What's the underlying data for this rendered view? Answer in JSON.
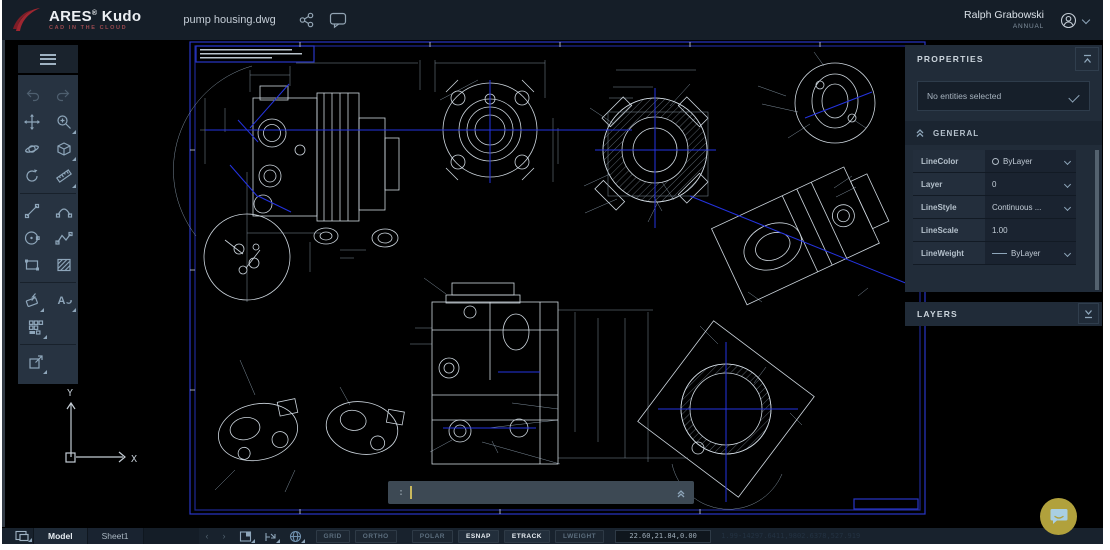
{
  "topbar": {
    "brand": "ARES",
    "brand_reg": "®",
    "brand_suffix": " Kudo",
    "brand_tagline": "CAD IN THE CLOUD",
    "filename": "pump housing.dwg",
    "user_name": "Ralph Grabowski",
    "user_plan": "ANNUAL"
  },
  "toolbar": {
    "tools": [
      "undo",
      "redo",
      "pan",
      "zoom",
      "orbit",
      "named-views",
      "rotate-view",
      "measure",
      "line",
      "arc",
      "circle",
      "polyline",
      "rectangle",
      "hatch",
      "modify",
      "text",
      "blocks",
      "export"
    ]
  },
  "properties_panel": {
    "title": "PROPERTIES",
    "selection_placeholder": "No entities selected",
    "general_section": "GENERAL",
    "rows": [
      {
        "label": "LineColor",
        "value": "ByLayer"
      },
      {
        "label": "Layer",
        "value": "0"
      },
      {
        "label": "LineStyle",
        "value": "Continuous ..."
      },
      {
        "label": "LineScale",
        "value": "1.00"
      },
      {
        "label": "LineWeight",
        "value": "ByLayer"
      }
    ]
  },
  "layers_panel": {
    "title": "LAYERS"
  },
  "command_bar": {
    "prompt": ":"
  },
  "statusbar": {
    "tabs": [
      "Model",
      "Sheet1"
    ],
    "nav_prev": "‹",
    "nav_next": "›",
    "toggles": [
      {
        "label": "GRID",
        "active": false
      },
      {
        "label": "ORTHO",
        "active": false
      },
      {
        "label": "POLAR",
        "active": false
      },
      {
        "label": "ESNAP",
        "active": true
      },
      {
        "label": "ETRACK",
        "active": true
      },
      {
        "label": "LWEIGHT",
        "active": false
      }
    ],
    "coordinates": "22.60,21.84,0.00",
    "session_info": "1.99-14297.6411,9802.6378,527.919"
  },
  "ucs": {
    "x_label": "X",
    "y_label": "Y"
  },
  "colors": {
    "accent_blue": "#2433e0",
    "line_white": "#cdd6de",
    "dim_text": "#9aabba",
    "chat_fab": "#b1a13c"
  },
  "canvas": {
    "sheet_code": "E**120-E905 B",
    "texts": [
      {
        "x": 204,
        "y": 84,
        "s": "64.47°"
      },
      {
        "x": 248,
        "y": 73,
        "s": "1.44"
      },
      {
        "x": 256,
        "y": 86,
        "s": ".78"
      },
      {
        "x": 326,
        "y": 61,
        "s": "3.10"
      },
      {
        "x": 408,
        "y": 75,
        "s": "1.85"
      },
      {
        "x": 452,
        "y": 79,
        "s": "Ø.31 THRU TO BORE"
      },
      {
        "x": 456,
        "y": 61,
        "s": "1.05"
      },
      {
        "x": 430,
        "y": 108,
        "s": "1.44"
      },
      {
        "x": 432,
        "y": 136,
        "s": "1.73"
      },
      {
        "x": 188,
        "y": 131,
        "s": "1.20"
      },
      {
        "x": 212,
        "y": 119,
        "s": ".82"
      },
      {
        "x": 290,
        "y": 83,
        "s": "TX HOLE 1"
      },
      {
        "x": 293,
        "y": 214,
        "s": "TX HOLE 2"
      },
      {
        "x": 296,
        "y": 228,
        "s": "TIE HOLE 3"
      },
      {
        "x": 333,
        "y": 212,
        "s": "2X Ø.41",
        "r": -75
      },
      {
        "x": 341,
        "y": 214,
        "s": "∇.63 .05",
        "r": -75
      },
      {
        "x": 206,
        "y": 198,
        "s": "8X Ø0.15 ∇0.13"
      },
      {
        "x": 206,
        "y": 206,
        "s": "∇Ø .23 X 82°"
      },
      {
        "x": 283,
        "y": 289,
        "s": "Ø.142 THRU"
      },
      {
        "x": 288,
        "y": 296,
        "s": "Ø .56 ∇.133"
      },
      {
        "x": 227,
        "y": 294,
        "s": "DETAIL H",
        "c": "big"
      },
      {
        "x": 318,
        "y": 231,
        "s": "R.38"
      },
      {
        "x": 362,
        "y": 250,
        "s": ".56"
      },
      {
        "x": 348,
        "y": 264,
        "s": ".49"
      },
      {
        "x": 386,
        "y": 104,
        "s": "H"
      },
      {
        "x": 414,
        "y": 159,
        "s": "R1.9"
      },
      {
        "x": 582,
        "y": 107,
        "s": "R14"
      },
      {
        "x": 577,
        "y": 185,
        "s": "R119"
      },
      {
        "x": 574,
        "y": 214,
        "s": "R149"
      },
      {
        "x": 638,
        "y": 235,
        "s": "SECTION E-E",
        "c": "big"
      },
      {
        "x": 547,
        "y": 136,
        "s": "1.69"
      },
      {
        "x": 545,
        "y": 174,
        "s": "1.77"
      },
      {
        "x": 568,
        "y": 142,
        "s": ".27"
      },
      {
        "x": 615,
        "y": 74,
        "s": "1.70"
      },
      {
        "x": 612,
        "y": 90,
        "s": "1.29"
      },
      {
        "x": 608,
        "y": 101,
        "s": ".86"
      },
      {
        "x": 684,
        "y": 80,
        "s": "23.46°"
      },
      {
        "x": 694,
        "y": 108,
        "s": "1.43"
      },
      {
        "x": 672,
        "y": 204,
        "s": "Ø.29"
      },
      {
        "x": 661,
        "y": 214,
        "s": ".85"
      },
      {
        "x": 642,
        "y": 226,
        "s": "26.06°"
      },
      {
        "x": 826,
        "y": 154,
        "s": "DETAIL F",
        "c": "big"
      },
      {
        "x": 750,
        "y": 103,
        "s": "2X R.17"
      },
      {
        "x": 783,
        "y": 138,
        "s": "4X R.24"
      },
      {
        "x": 870,
        "y": 131,
        "s": "Ø1.47"
      },
      {
        "x": 754,
        "y": 84,
        "s": "1.25"
      },
      {
        "x": 810,
        "y": 51,
        "s": "8X Ø.41 ∇.63"
      },
      {
        "x": 851,
        "y": 175,
        "s": ".70"
      },
      {
        "x": 855,
        "y": 186,
        "s": ".39"
      },
      {
        "x": 393,
        "y": 334,
        "s": "1.6500"
      },
      {
        "x": 386,
        "y": 349,
        "s": "2.7304"
      },
      {
        "x": 552,
        "y": 334,
        "s": "2.15"
      },
      {
        "x": 569,
        "y": 367,
        "s": "4.75"
      },
      {
        "x": 592,
        "y": 367,
        "s": "3X 4.95"
      },
      {
        "x": 628,
        "y": 367,
        "s": "4.6130"
      },
      {
        "x": 584,
        "y": 453,
        "s": "0.8006"
      },
      {
        "x": 559,
        "y": 409,
        "s": "BOSS C"
      },
      {
        "x": 560,
        "y": 420,
        "s": "BOSS A"
      },
      {
        "x": 562,
        "y": 466,
        "s": "BOSS B"
      },
      {
        "x": 402,
        "y": 454,
        "s": "BOSS E"
      },
      {
        "x": 477,
        "y": 456,
        "s": "BOSS F"
      },
      {
        "x": 393,
        "y": 279,
        "s": "BOSS N"
      },
      {
        "x": 430,
        "y": 331,
        "s": "E"
      },
      {
        "x": 546,
        "y": 327,
        "s": "E"
      },
      {
        "x": 225,
        "y": 358,
        "s": "BOSS G"
      },
      {
        "x": 327,
        "y": 385,
        "s": "BOSS N"
      },
      {
        "x": 206,
        "y": 492,
        "s": "BOSS F"
      },
      {
        "x": 275,
        "y": 495,
        "s": "BOSS G"
      },
      {
        "x": 702,
        "y": 325,
        "s": "0.25"
      },
      {
        "x": 670,
        "y": 370,
        "s": ".20"
      },
      {
        "x": 658,
        "y": 379,
        "s": "0.25"
      },
      {
        "x": 765,
        "y": 366,
        "s": ".30"
      },
      {
        "x": 802,
        "y": 427,
        "s": "1.30"
      },
      {
        "x": 660,
        "y": 473,
        "s": "91.34°"
      },
      {
        "x": 756,
        "y": 481,
        "s": "45.00°"
      },
      {
        "x": 722,
        "y": 498,
        "s": "ON G-G",
        "c": "big"
      },
      {
        "x": 747,
        "y": 293,
        "s": "4.55"
      },
      {
        "x": 868,
        "y": 289,
        "s": "Ø0.43 TH"
      },
      {
        "x": 858,
        "y": 507,
        "s": "E**120-E905 B",
        "c": "blue"
      }
    ]
  }
}
